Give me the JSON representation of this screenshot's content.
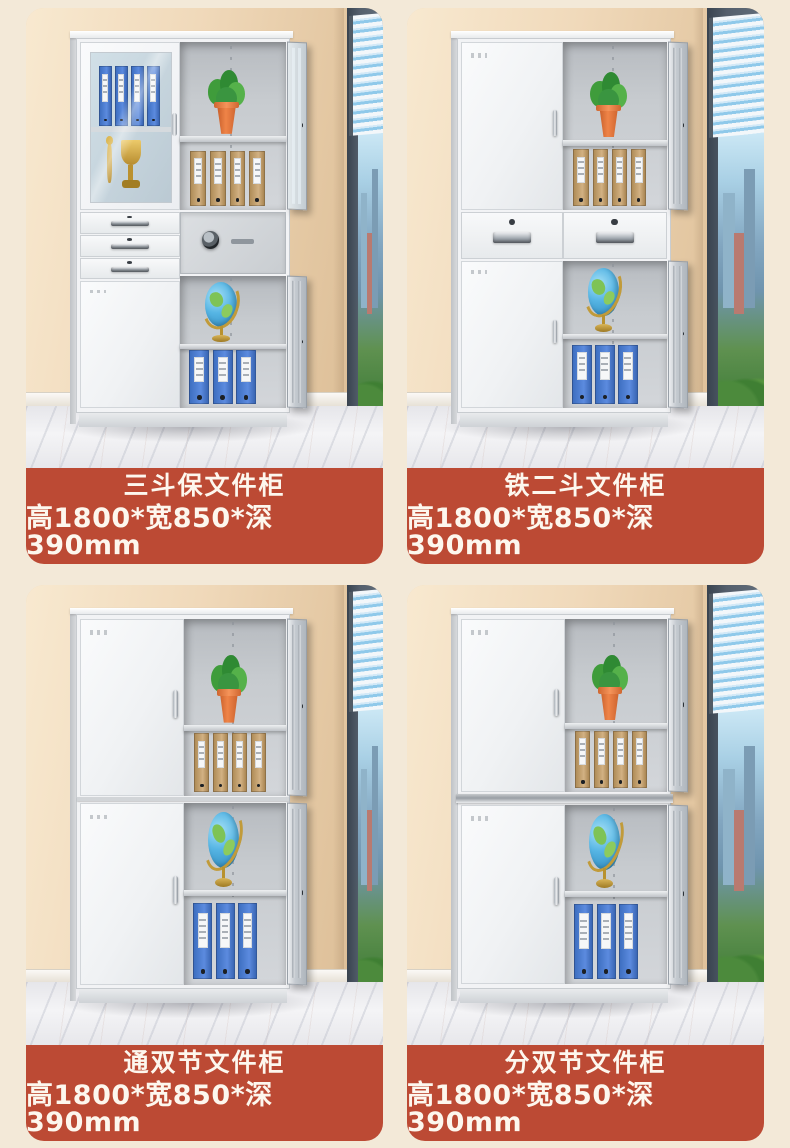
{
  "page": {
    "background_color": "#f3e9d8",
    "accent_color": "#bc4a34",
    "label_text_color": "#fdf7ee"
  },
  "products": [
    {
      "title": "三斗保文件柜",
      "dimensions": "高1800*宽850*深390mm",
      "photo_variant": "glass-top-three-drawer-safe-cabinet",
      "window_style": "narrow"
    },
    {
      "title": "铁二斗文件柜",
      "dimensions": "高1800*宽850*深390mm",
      "photo_variant": "two-drawer-middle-cabinet",
      "window_style": "wide"
    },
    {
      "title": "通双节文件柜",
      "dimensions": "高1800*宽850*深390mm",
      "photo_variant": "double-section-joined-cabinet",
      "window_style": "narrow"
    },
    {
      "title": "分双节文件柜",
      "dimensions": "高1800*宽850*深390mm",
      "photo_variant": "double-section-split-cabinet",
      "window_style": "wide"
    }
  ]
}
